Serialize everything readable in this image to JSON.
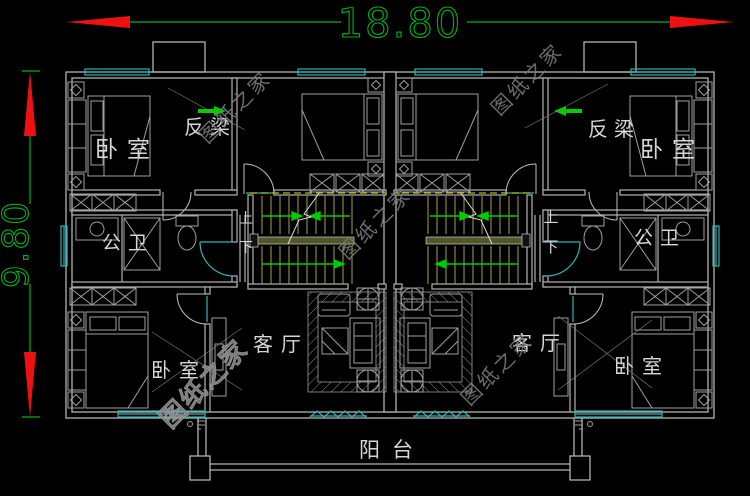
{
  "colors": {
    "background": "#000000",
    "wall_gray": "#b3b3b3",
    "furniture_gray": "#9f9f9f",
    "window_cyan": "#2fb3b3",
    "dimension_green": "#00b020",
    "arrow_red": "#ee1111",
    "tread_olive": "#a2a24a",
    "beam_dash_yellow": "#b8b800",
    "stair_arrow_green": "#00cc00",
    "label_light": "#d6d6d6",
    "watermark_gray": "#7a7a7a"
  },
  "dimensions": {
    "width": "18.80",
    "height": "9.80"
  },
  "rooms": {
    "bedroom": "卧室",
    "living_room": "客厅",
    "shared_bathroom": "公卫",
    "balcony": "阳台",
    "inverted_beam": "反梁",
    "stair_up": "上",
    "stair_down": "下"
  },
  "watermark": "图纸之家"
}
